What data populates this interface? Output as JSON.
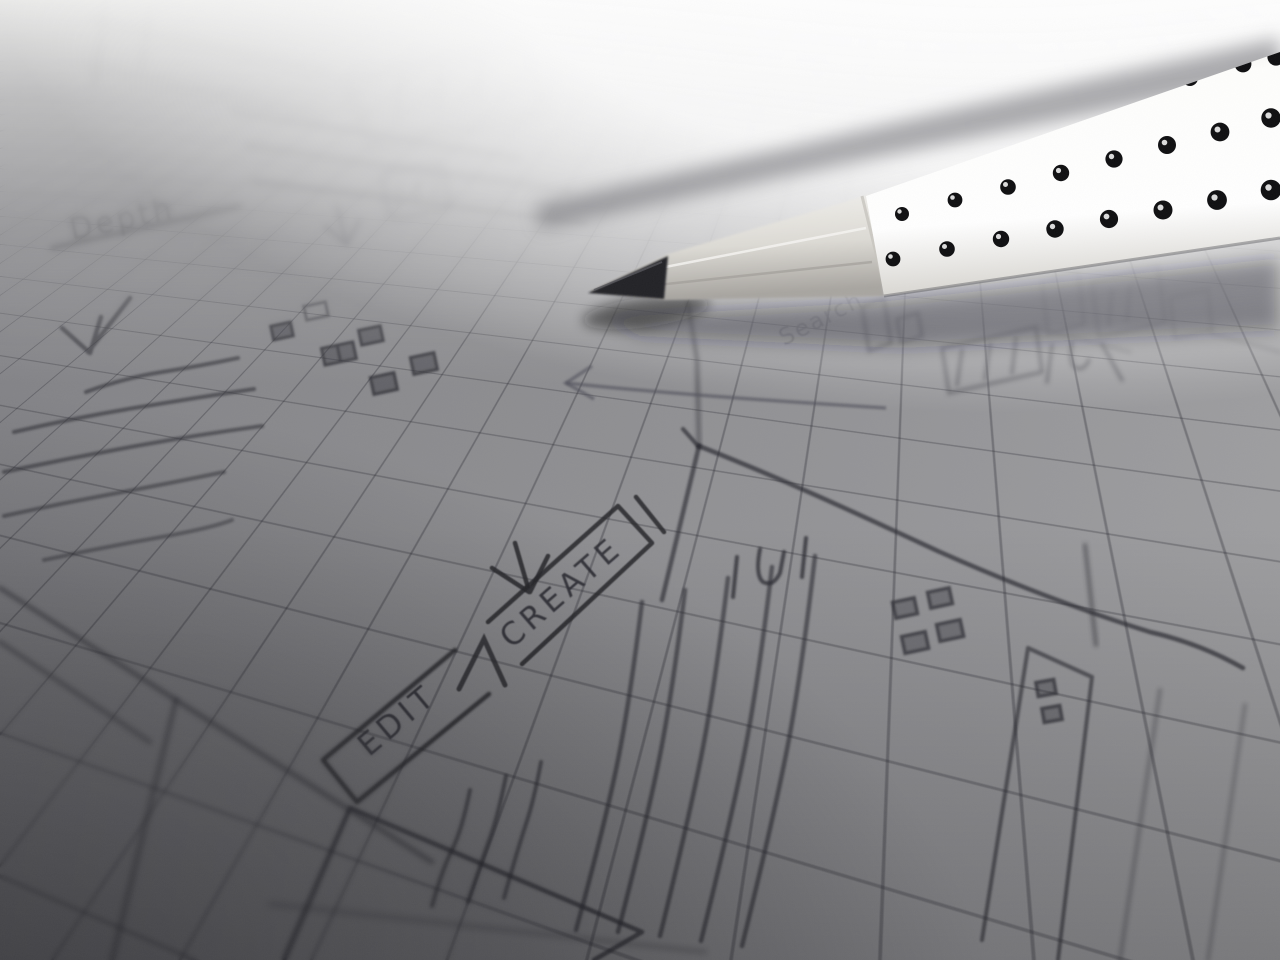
{
  "scene": {
    "description": "Black-and-white close-up photograph of hand-drawn UI wireframe sketches on squared graph paper, with a sharpened white grip pencil with black dots resting across the top right",
    "labels": {
      "depth": "Depth",
      "search": "Search",
      "edit_tab": "EDIT",
      "create_tab": "CREATE"
    },
    "sketch_elements": [
      "edit-create-tab-bar",
      "pointer-arrows",
      "text-placeholder-scribbles",
      "icon-grid-squares",
      "form-field-bars",
      "content-rectangles"
    ],
    "colors": {
      "paper_highlight": "#fbfbf9",
      "paper_mid": "#8f8f91",
      "paper_shadow": "#55555a",
      "grid_line": "#2f2f36",
      "pencil_line": "#2a2a2e",
      "graphite_tip": "#232326",
      "pencil_body": "#ffffff",
      "pencil_dots": "#0e0e10"
    }
  }
}
